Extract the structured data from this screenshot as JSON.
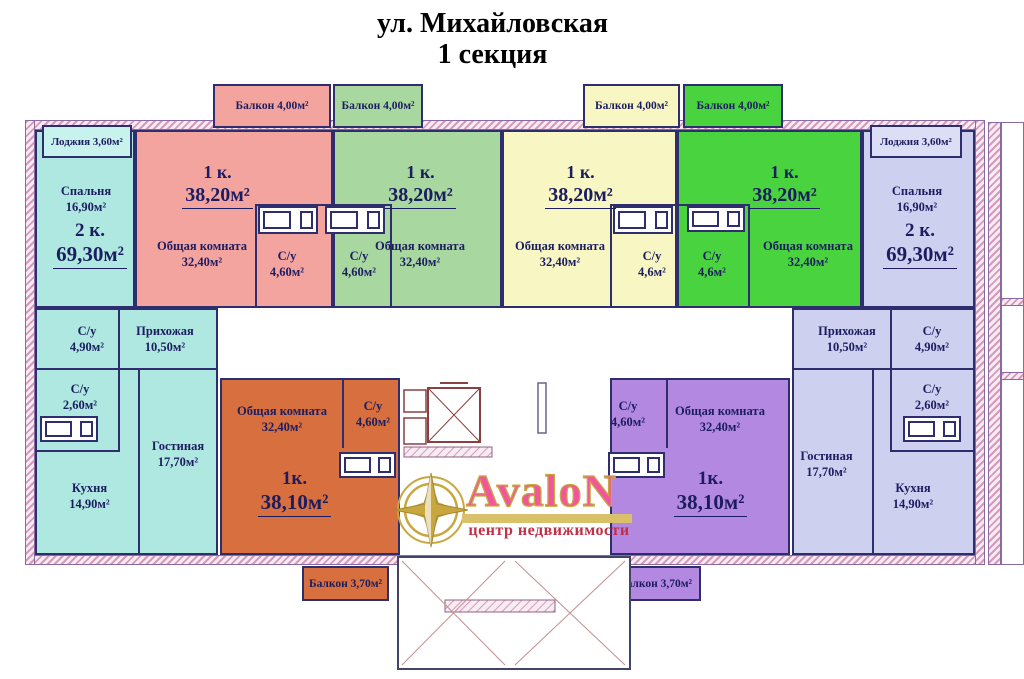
{
  "title": {
    "line1": "ул. Михайловская",
    "line2": "1 секция"
  },
  "logo": {
    "brand": "AvaloN",
    "tagline": "центр недвижимости"
  },
  "apartments": {
    "left2k": {
      "type_label": "2 к.",
      "area_label": "69,30м²",
      "loggia": "Лоджия 3,60м²",
      "bedroom": {
        "name": "Спальня",
        "area": "16,90м²"
      },
      "wc1": {
        "name": "С/у",
        "area": "4,90м²"
      },
      "hall": {
        "name": "Прихожая",
        "area": "10,50м²"
      },
      "wc2": {
        "name": "С/у",
        "area": "2,60м²"
      },
      "kitchen": {
        "name": "Кухня",
        "area": "14,90м²"
      },
      "living": {
        "name": "Гостиная",
        "area": "17,70м²"
      }
    },
    "flat1_pink": {
      "type_label": "1 к.",
      "area_label": "38,20м²",
      "common": {
        "name": "Общая комната",
        "area": "32,40м²"
      },
      "wc": {
        "name": "С/у",
        "area": "4,60м²"
      },
      "balcony": "Балкон 4,00м²"
    },
    "flat2_green": {
      "type_label": "1 к.",
      "area_label": "38,20м²",
      "common": {
        "name": "Общая комната",
        "area": "32,40м²"
      },
      "wc": {
        "name": "С/у",
        "area": "4,60м²"
      },
      "balcony": "Балкон 4,00м²"
    },
    "flat3_yellow": {
      "type_label": "1 к.",
      "area_label": "38,20м²",
      "common": {
        "name": "Общая комната",
        "area": "32,40м²"
      },
      "wc": {
        "name": "С/у",
        "area": "4,6м²"
      },
      "balcony": "Балкон 4,00м²"
    },
    "flat4_bright": {
      "type_label": "1 к.",
      "area_label": "38,20м²",
      "common": {
        "name": "Общая комната",
        "area": "32,40м²"
      },
      "wc": {
        "name": "С/у",
        "area": "4,6м²"
      },
      "balcony": "Балкон 4,00м²"
    },
    "right2k": {
      "type_label": "2 к.",
      "area_label": "69,30м²",
      "loggia": "Лоджия 3,60м²",
      "bedroom": {
        "name": "Спальня",
        "area": "16,90м²"
      },
      "wc1": {
        "name": "С/у",
        "area": "4,90м²"
      },
      "hall": {
        "name": "Прихожая",
        "area": "10,50м²"
      },
      "wc2": {
        "name": "С/у",
        "area": "2,60м²"
      },
      "kitchen": {
        "name": "Кухня",
        "area": "14,90м²"
      },
      "living": {
        "name": "Гостиная",
        "area": "17,70м²"
      }
    },
    "flat5_orange": {
      "type_label": "1к.",
      "area_label": "38,10м²",
      "common": {
        "name": "Общая комната",
        "area": "32,40м²"
      },
      "wc": {
        "name": "С/у",
        "area": "4,60м²"
      },
      "balcony": "Балкон 3,70м²"
    },
    "flat6_purple": {
      "type_label": "1к.",
      "area_label": "38,10м²",
      "common": {
        "name": "Общая комната",
        "area": "32,40м²"
      },
      "wc": {
        "name": "С/у",
        "area": "4,60м²"
      },
      "balcony": "Балкон 3,70м²"
    }
  },
  "colors": {
    "teal": "#aee8e0",
    "pink": "#f4a49f",
    "green": "#a8d8a0",
    "yellow": "#f8f7c4",
    "bright_green": "#49d33e",
    "lavender": "#cdd1ef",
    "orange": "#d7703e",
    "purple": "#b388e1",
    "wall": "#2e2e6e",
    "wall_hatch": "#d898bc",
    "label_text": "#1c1c60",
    "logo_pink": "#f2559c",
    "logo_gold": "#c9a73f",
    "logo_red": "#c23048"
  }
}
